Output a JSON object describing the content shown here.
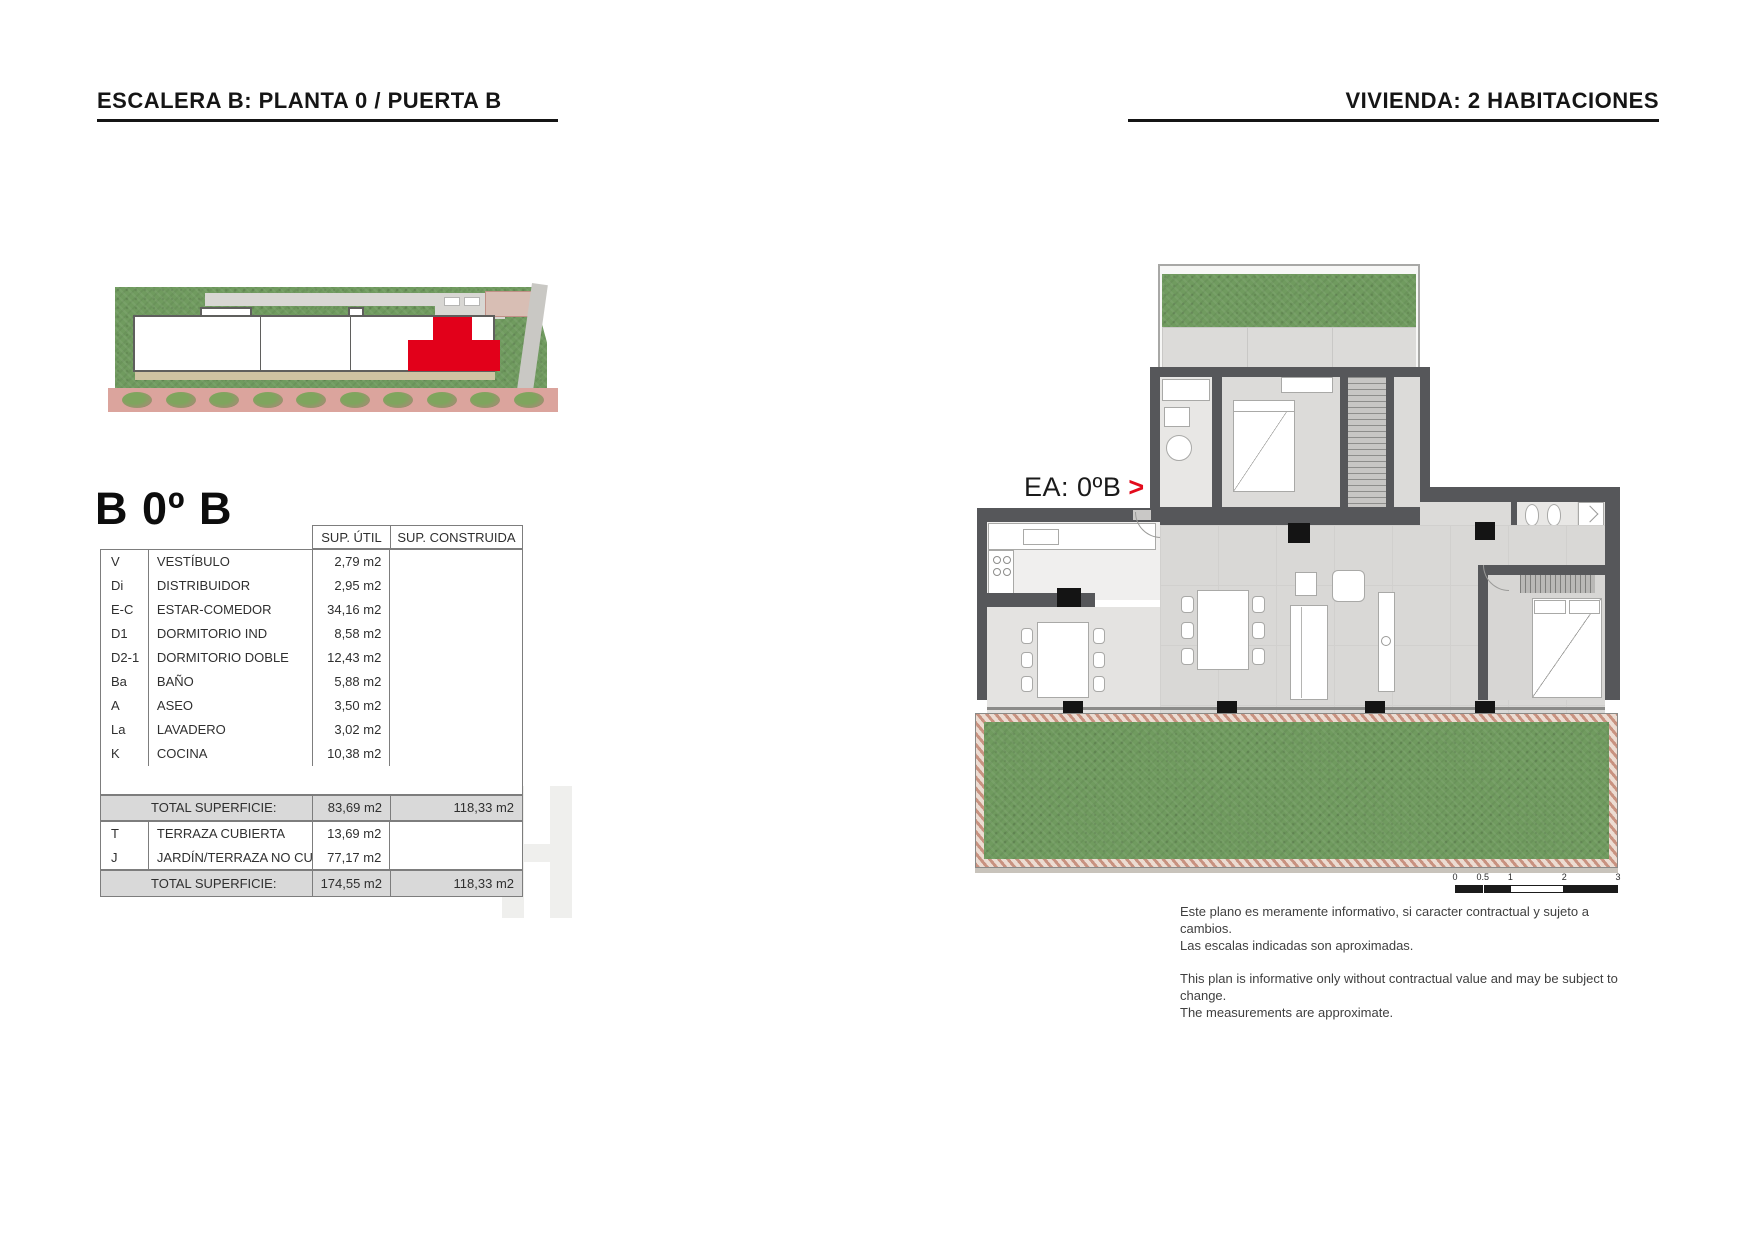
{
  "header": {
    "left_title": "ESCALERA B: PLANTA 0 / PUERTA B",
    "right_title": "VIVIENDA: 2 HABITACIONES"
  },
  "unit": {
    "title": "B 0º B",
    "plan_label": "EA: 0ºB",
    "plan_label_arrow": ">"
  },
  "table": {
    "col_headers": {
      "util": "SUP. ÚTIL",
      "constr": "SUP. CONSTRUIDA"
    },
    "rows": [
      {
        "code": "V",
        "name": "VESTÍBULO",
        "util": "2,79 m2",
        "constr": ""
      },
      {
        "code": "Di",
        "name": "DISTRIBUIDOR",
        "util": "2,95 m2",
        "constr": ""
      },
      {
        "code": "E-C",
        "name": "ESTAR-COMEDOR",
        "util": "34,16 m2",
        "constr": ""
      },
      {
        "code": "D1",
        "name": "DORMITORIO IND",
        "util": "8,58 m2",
        "constr": ""
      },
      {
        "code": "D2-1",
        "name": "DORMITORIO DOBLE",
        "util": "12,43 m2",
        "constr": ""
      },
      {
        "code": "Ba",
        "name": "BAÑO",
        "util": "5,88 m2",
        "constr": ""
      },
      {
        "code": "A",
        "name": "ASEO",
        "util": "3,50 m2",
        "constr": ""
      },
      {
        "code": "La",
        "name": "LAVADERO",
        "util": "3,02 m2",
        "constr": ""
      },
      {
        "code": "K",
        "name": "COCINA",
        "util": "10,38 m2",
        "constr": ""
      }
    ],
    "total_interior": {
      "label": "TOTAL SUPERFICIE:",
      "util": "83,69 m2",
      "constr": "118,33 m2"
    },
    "exterior_rows": [
      {
        "code": "T",
        "name": "TERRAZA CUBIERTA",
        "util": "13,69 m2",
        "constr": ""
      },
      {
        "code": "J",
        "name": "JARDÍN/TERRAZA NO CUB.",
        "util": "77,17 m2",
        "constr": ""
      }
    ],
    "total_overall": {
      "label": "TOTAL SUPERFICIE:",
      "util": "174,55 m2",
      "constr": "118,33 m2"
    }
  },
  "site_plan": {
    "tree_count": 10,
    "highlight_color": "#e2001a"
  },
  "floorplan": {
    "scale_ticks": [
      "0",
      "0.5",
      "1",
      "2",
      "3"
    ]
  },
  "disclaimer": {
    "es1": "Este plano es meramente informativo, si caracter contractual y sujeto a cambios.",
    "es2": "Las escalas indicadas son aproximadas.",
    "en1": "This plan is informative only without contractual value and may be subject to change.",
    "en2": "The measurements are approximate."
  },
  "colors": {
    "accent_red": "#e2001a",
    "wall_gray": "#56575a",
    "garden_green": "#709b5f"
  }
}
